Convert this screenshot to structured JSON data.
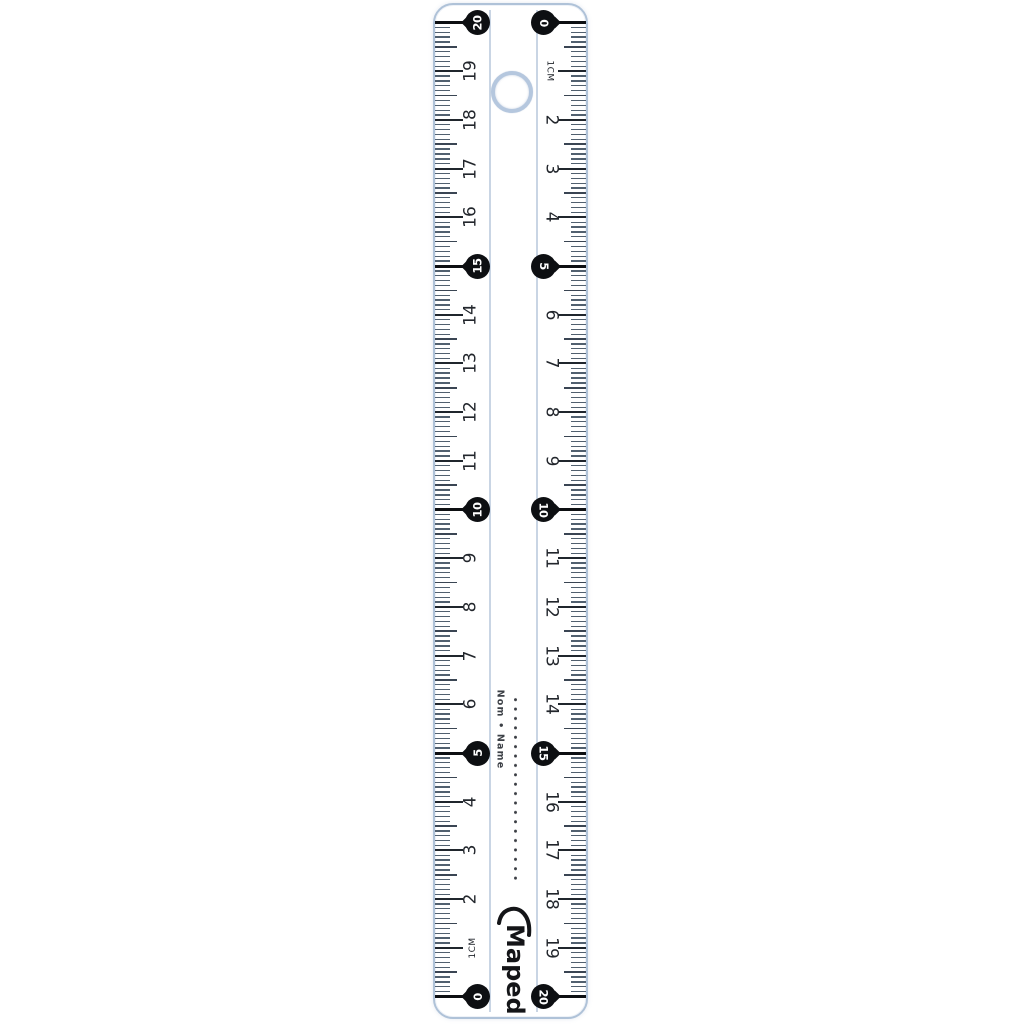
{
  "page": {
    "background": "#ffffff"
  },
  "ruler": {
    "type": "20 cm double-scale ruler",
    "brand_logo": "Maped",
    "name_label": "Nom • Name",
    "hole": "hanging-hole",
    "cm_total": 20,
    "left_scale": {
      "zero_at": "bottom",
      "unit_label": "1cm",
      "unit_label_at_cm": 1,
      "plain_numbers": [
        2,
        3,
        4,
        6,
        7,
        8,
        9,
        11,
        12,
        13,
        14,
        16,
        17,
        18,
        19
      ],
      "drop_numbers": [
        0,
        5,
        10,
        15,
        20
      ]
    },
    "right_scale": {
      "zero_at": "top",
      "unit_label": "1cm",
      "unit_label_at_cm": 1,
      "plain_numbers": [
        2,
        3,
        4,
        6,
        7,
        8,
        9,
        11,
        12,
        13,
        14,
        16,
        17,
        18,
        19
      ],
      "drop_numbers": [
        0,
        5,
        10,
        15,
        20
      ]
    }
  },
  "colors": {
    "edge": "#afc2d8",
    "tick_mm": "#51606f",
    "tick_half": "#3a4553",
    "tick_cm": "#20262d",
    "marker": "#0d0f12",
    "marker_text": "#ffffff",
    "number": "#22262c",
    "center_line": "#c9d5e4",
    "hole_ring": "#b5c7de",
    "dots": "#3b3e44",
    "logo": "#141518",
    "name_text": "#3c4046"
  }
}
